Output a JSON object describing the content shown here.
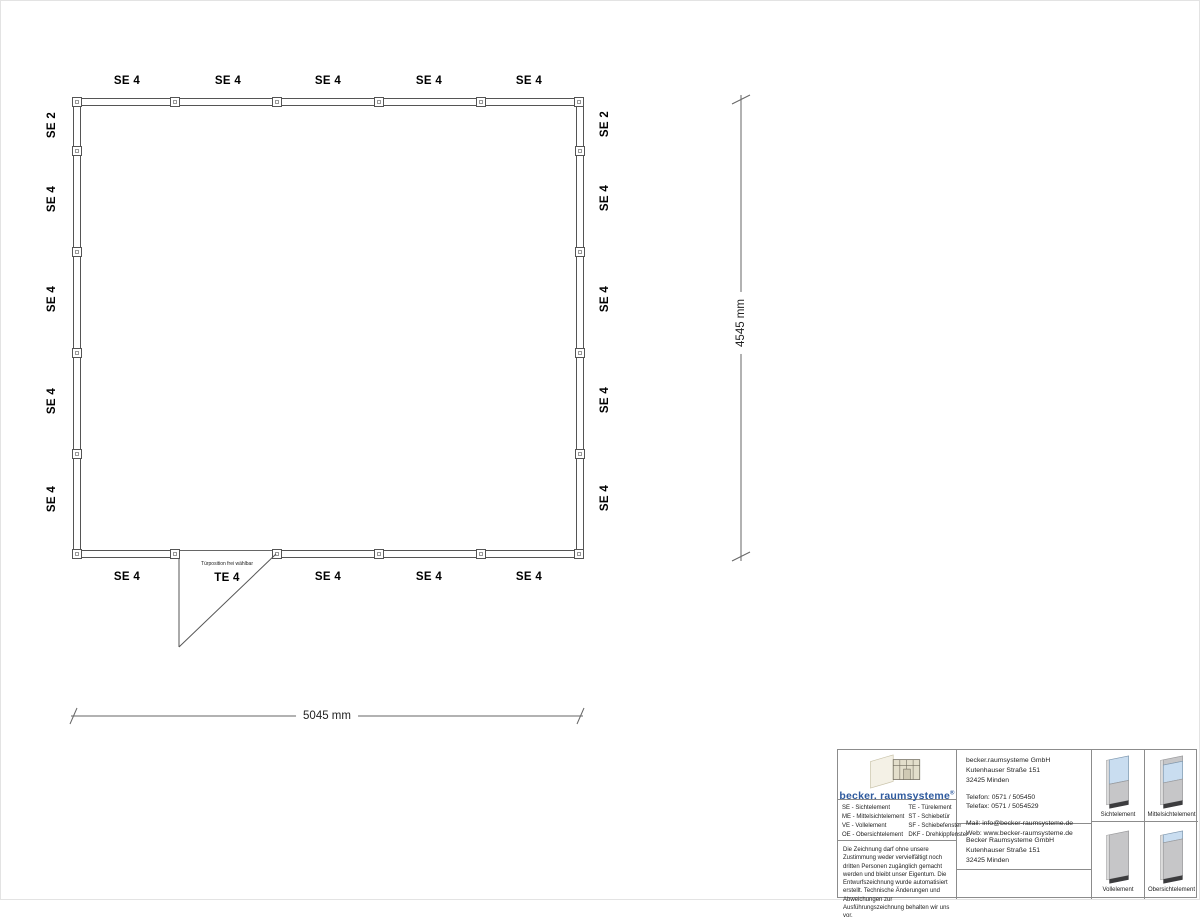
{
  "plan": {
    "walls": {
      "top_labels": [
        "SE 4",
        "SE 4",
        "SE 4",
        "SE 4",
        "SE 4"
      ],
      "bottom_labels": [
        "SE 4",
        "TE 4",
        "SE 4",
        "SE 4",
        "SE 4"
      ],
      "left_labels": [
        "SE 2",
        "SE 4",
        "SE 4",
        "SE 4",
        "SE 4"
      ],
      "right_labels": [
        "SE 2",
        "SE 4",
        "SE 4",
        "SE 4",
        "SE 4"
      ]
    },
    "door_note": "Türposition frei wählbar",
    "dimensions": {
      "width_label": "5045 mm",
      "height_label": "4545 mm"
    }
  },
  "title_block": {
    "logo_text": "becker. raumsysteme",
    "logo_registered": "®",
    "legend": {
      "col1": [
        "SE - Sichtelement",
        "ME - Mittelsichtelement",
        "VE - Vollelement",
        "OE - Obersichtelement"
      ],
      "col2": [
        "TE - Türelement",
        "ST - Schiebetür",
        "SF - Schiebefenster",
        "DKF - Drehkippfenster"
      ]
    },
    "disclaimer": "Die Zeichnung darf ohne unsere Zustimmung weder vervielfältigt noch dritten Personen zugänglich gemacht werden und bleibt unser Eigentum. Die Entwurfszeichnung wurde automatisiert erstellt. Technische Änderungen und Abweichungen zur Ausführungszeichnung behalten wir uns vor.",
    "contact": {
      "company": "becker.raumsysteme GmbH",
      "street": "Kutenhauser Straße 151",
      "city": "32425 Minden",
      "phone": "Telefon: 0571 / 505450",
      "fax": "Telefax: 0571 / 5054529",
      "mail": "Mail: info@becker-raumsysteme.de",
      "web": "Web: www.becker-raumsysteme.de"
    },
    "owner": {
      "company": "Becker Raumsysteme GmbH",
      "street": "Kutenhauser Straße 151",
      "city": "32425 Minden"
    },
    "element_types": [
      "Sichtelement",
      "Mittelsichtelement",
      "Vollelement",
      "Obersichtelement"
    ],
    "colors": {
      "logo_blue": "#2e5a9e",
      "glass": "#c9ddf0",
      "panel": "#c6c6c8",
      "base": "#3c3c3e"
    }
  }
}
